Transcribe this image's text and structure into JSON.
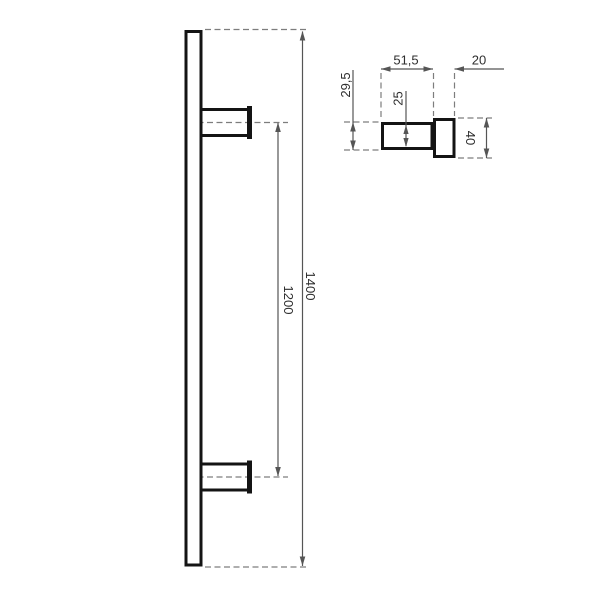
{
  "front_view": {
    "overall_length": "1400",
    "mounting_centers": "1200"
  },
  "side_view": {
    "post_length": "51,5",
    "bar_depth": "20",
    "post_outer_height": "29,5",
    "post_inner_height": "25",
    "bar_height": "40"
  },
  "colors": {
    "part_outline": "#141414",
    "dimension_lines": "#555555",
    "center_lines": "#7d7d7d",
    "dimension_text": "#2e2e2e",
    "background": "#ffffff"
  }
}
